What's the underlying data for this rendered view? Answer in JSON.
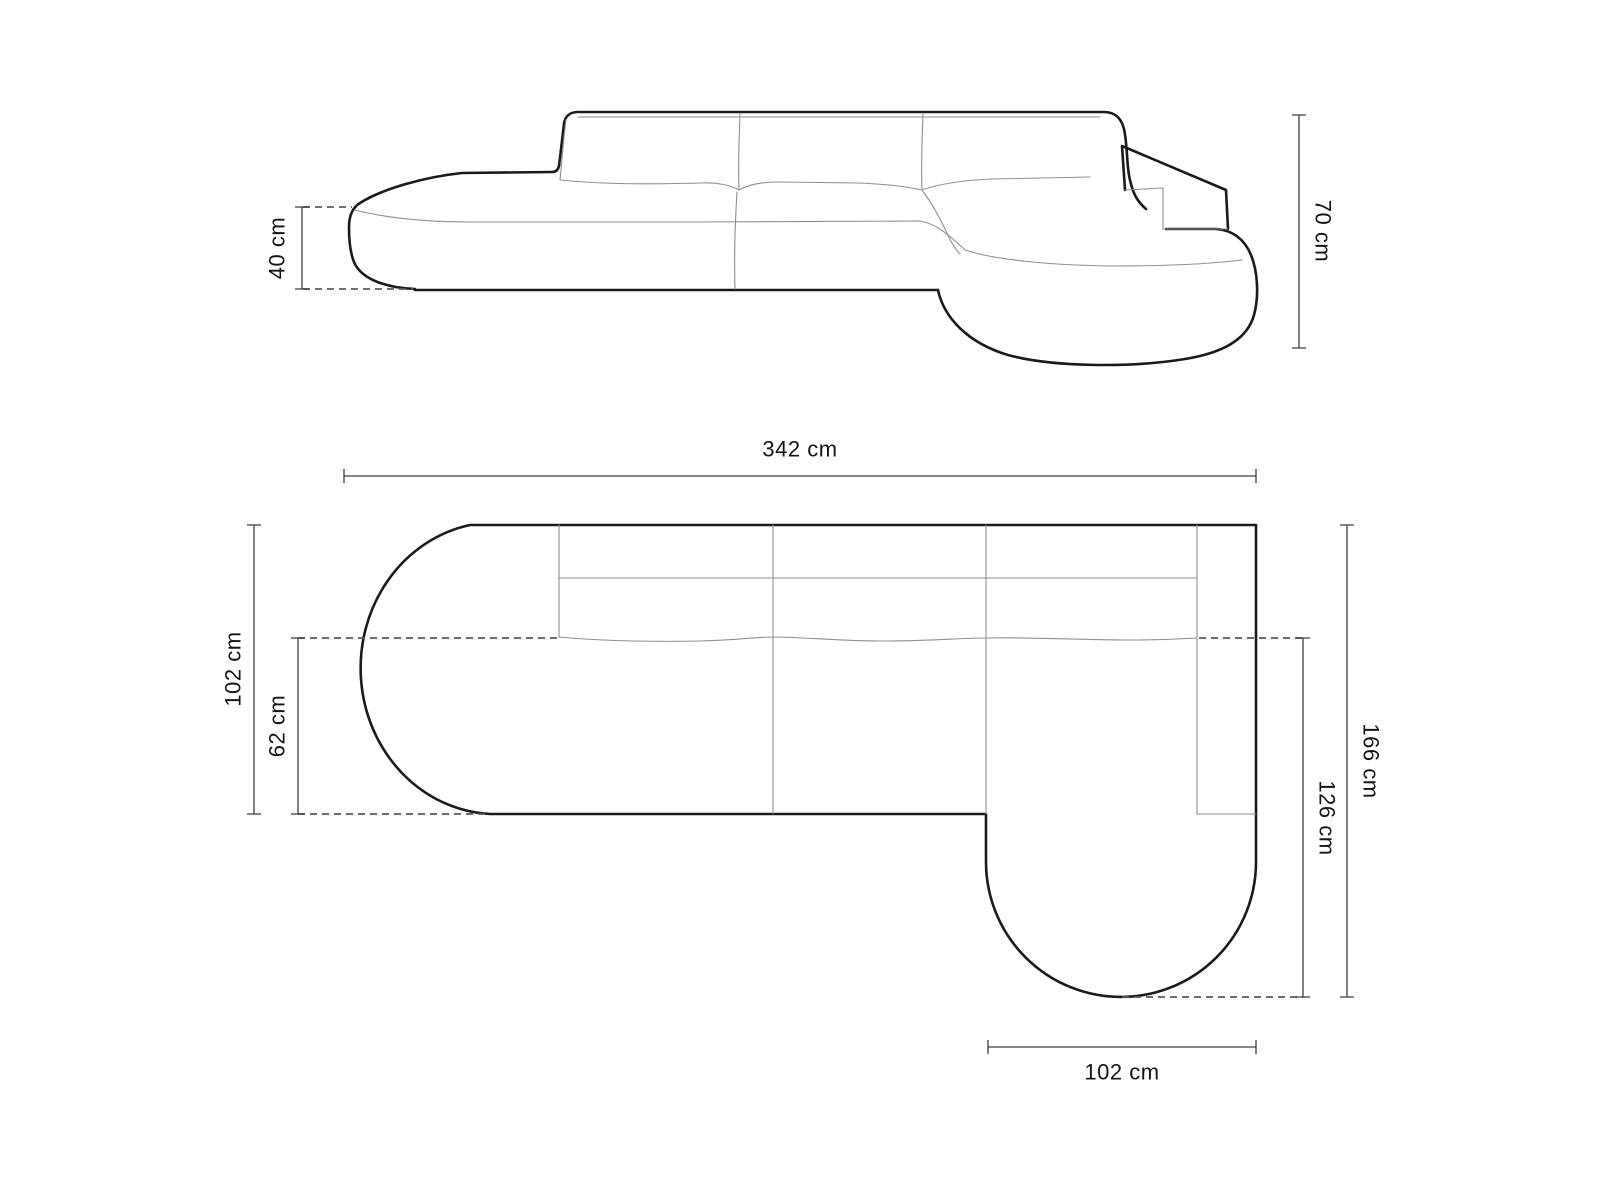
{
  "diagram": {
    "subject": "corner-sofa-dimension-drawing",
    "unit": "cm"
  },
  "side_view": {
    "seat_height_label": "40 cm",
    "total_height_label": "70 cm"
  },
  "top_view": {
    "total_width_label": "342 cm",
    "depth_label": "102 cm",
    "seat_depth_label": "62 cm",
    "total_depth_label": "166 cm",
    "chaise_depth_label": "126 cm",
    "chaise_width_label": "102 cm"
  },
  "colors": {
    "background": "#ffffff",
    "outline": "#1a1a1a",
    "inner_line": "#8f8f8f",
    "dimension_line": "#3d3d3d",
    "text": "#141414"
  }
}
